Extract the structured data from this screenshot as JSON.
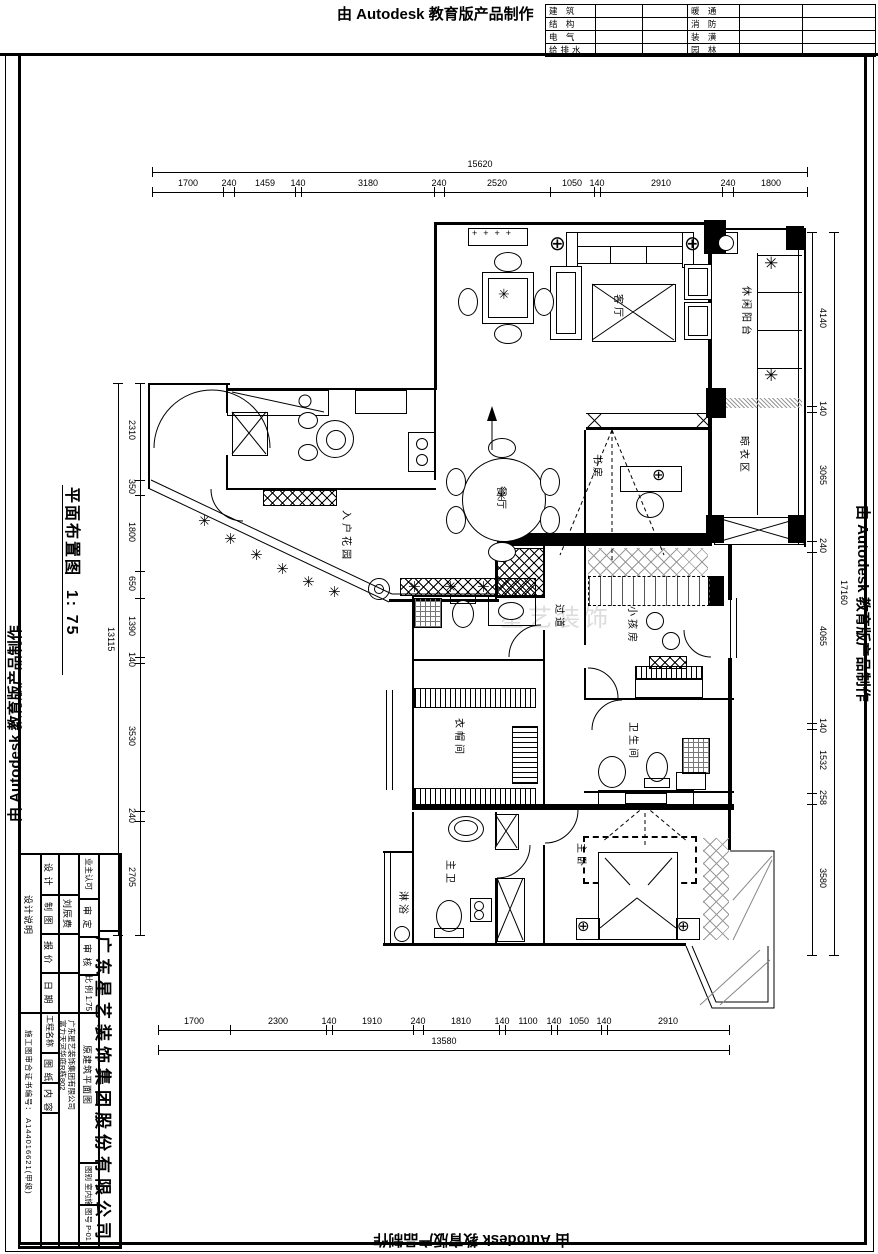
{
  "watermark": {
    "text": "由 Autodesk 教育版产品制作"
  },
  "stamp_table": {
    "rows": [
      {
        "l": "建 筑",
        "r": "暖 通"
      },
      {
        "l": "结 构",
        "r": "消 防"
      },
      {
        "l": "电 气",
        "r": "装 潢"
      },
      {
        "l": "给排水",
        "r": "园 林"
      }
    ]
  },
  "drawing_title": {
    "name": "平面布置图",
    "scale": "1: 75"
  },
  "logo_watermark": "星艺装饰",
  "dimensions": {
    "top": {
      "total": "15620",
      "segments": [
        "1700",
        "240",
        "1459",
        "140",
        "3180",
        "240",
        "2520",
        "1050",
        "140",
        "2910",
        "240",
        "1800"
      ]
    },
    "bottom": {
      "total": "13580",
      "segments": [
        "1700",
        "2300",
        "140",
        "1910",
        "240",
        "1810",
        "140",
        "1100",
        "140",
        "1050",
        "140",
        "2910"
      ]
    },
    "left": {
      "total": "13115",
      "segments": [
        "2310",
        "350",
        "1800",
        "650",
        "1390",
        "140",
        "3530",
        "240",
        "2705"
      ]
    },
    "right": {
      "total": "17160",
      "segments": [
        "4140",
        "140",
        "3065",
        "240",
        "4065",
        "140",
        "1532",
        "258",
        "3580"
      ]
    }
  },
  "rooms": {
    "living": "客厅",
    "dining": "餐厅",
    "study": "书房",
    "leisure_balcony": "休闲阳台",
    "laundry": "晾衣区",
    "entry_garden": "入户花园",
    "corridor": "过道",
    "kids_room": "小孩房",
    "cloakroom": "衣帽间",
    "bathroom": "卫生间",
    "master_bath": "主卫",
    "master_bedroom": "主卧",
    "shower": "淋浴"
  },
  "title_block": {
    "design_notes": "设计说明",
    "design": "设 计",
    "draft": "制 图",
    "draft_value": "刘辰费",
    "quote": "报 价",
    "date": "日 期",
    "owner_approval": "业主认可",
    "approved": "审 定",
    "checked": "审 核",
    "scale_row": "比 例  1:75",
    "company": "广东星艺装饰集团股份有限公司",
    "project_label": "工程名称",
    "project_value": "富力天河华庭R栋802",
    "company_sub": "广东星艺装饰集团有限公司",
    "sheet_label": "图 纸",
    "content_label": "内 容",
    "content_value": "原建筑平面图",
    "cert": "施工图审合证书编号：  A144016621(甲级)",
    "category_row": "图别  室内施",
    "number_row": "图号  P-01"
  }
}
